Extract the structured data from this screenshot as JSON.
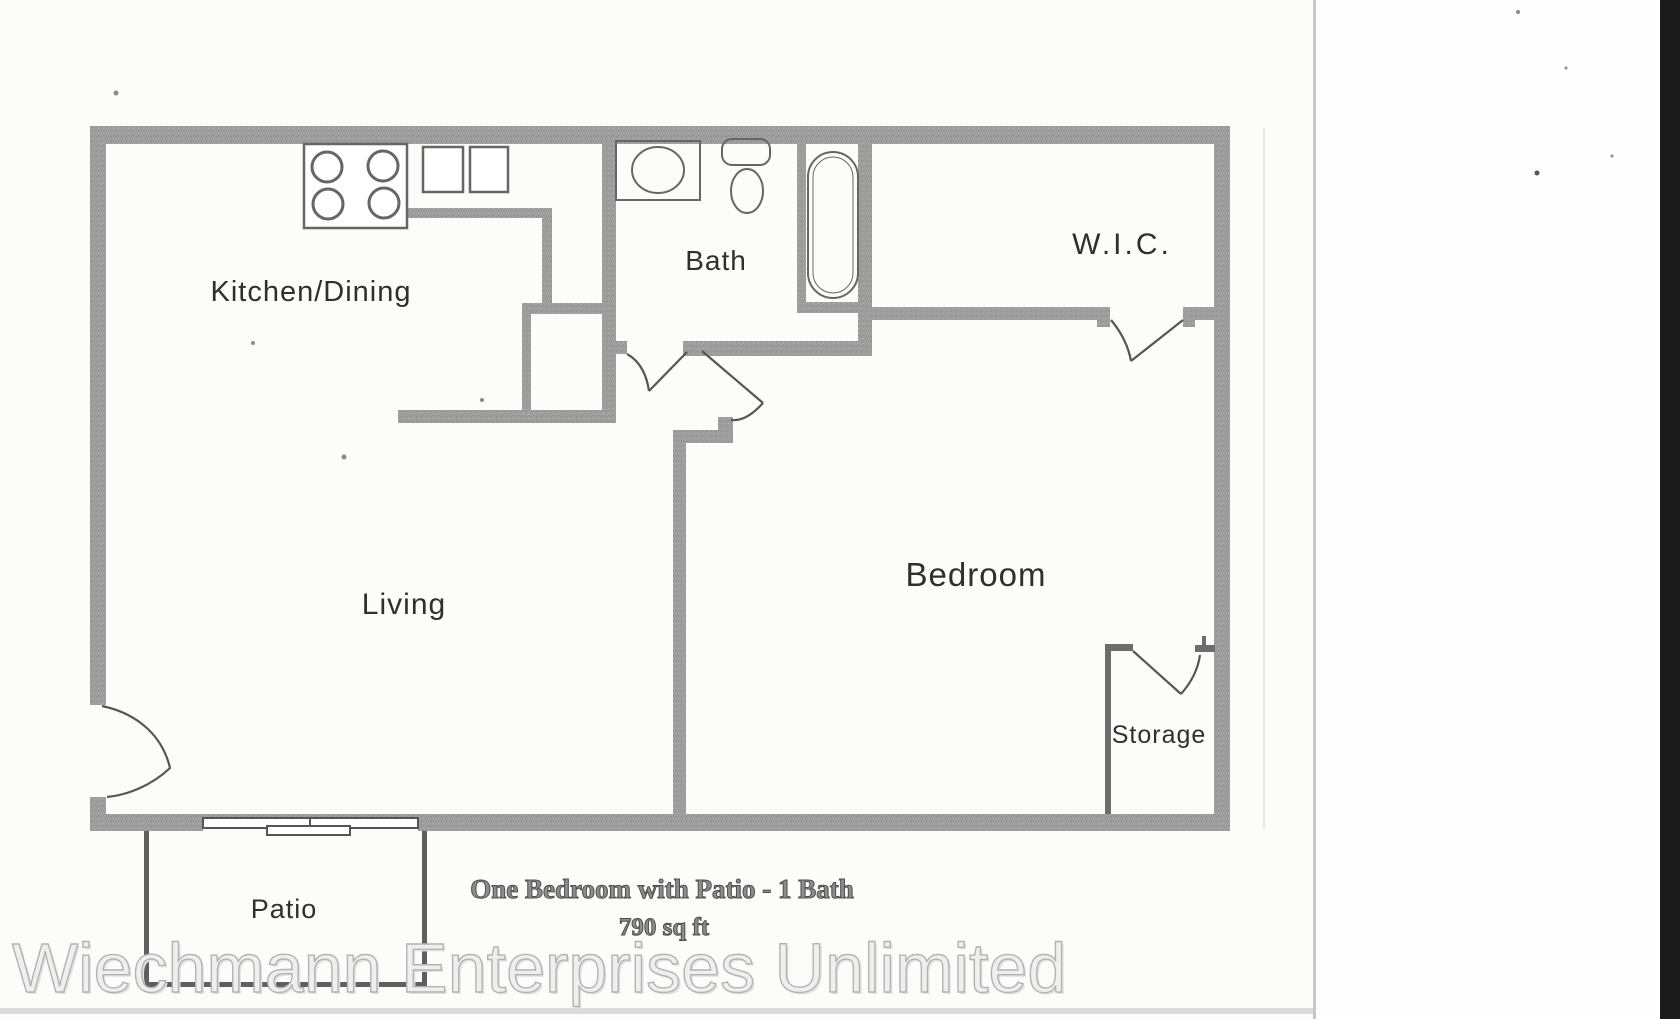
{
  "rooms": [
    {
      "id": "kitchen-dining",
      "label": "Kitchen/Dining"
    },
    {
      "id": "bath",
      "label": "Bath"
    },
    {
      "id": "wic",
      "label": "W.I.C."
    },
    {
      "id": "living",
      "label": "Living"
    },
    {
      "id": "bedroom",
      "label": "Bedroom"
    },
    {
      "id": "storage",
      "label": "Storage"
    },
    {
      "id": "patio",
      "label": "Patio"
    }
  ],
  "caption": {
    "title": "One Bedroom with Patio - 1 Bath",
    "area": "790 sq ft"
  },
  "watermark": "Wiechmann Enterprises Unlimited",
  "colors": {
    "wall": "#9a9a9a",
    "thin_line": "#4f4f4f",
    "fixture_stroke": "#666666",
    "label_text": "#2f2f2f",
    "caption_text": "#5a5a5a",
    "watermark_text": "#d9d9d9",
    "page": "#fcfcfb",
    "scanner_edge": "#1b1b1b"
  }
}
